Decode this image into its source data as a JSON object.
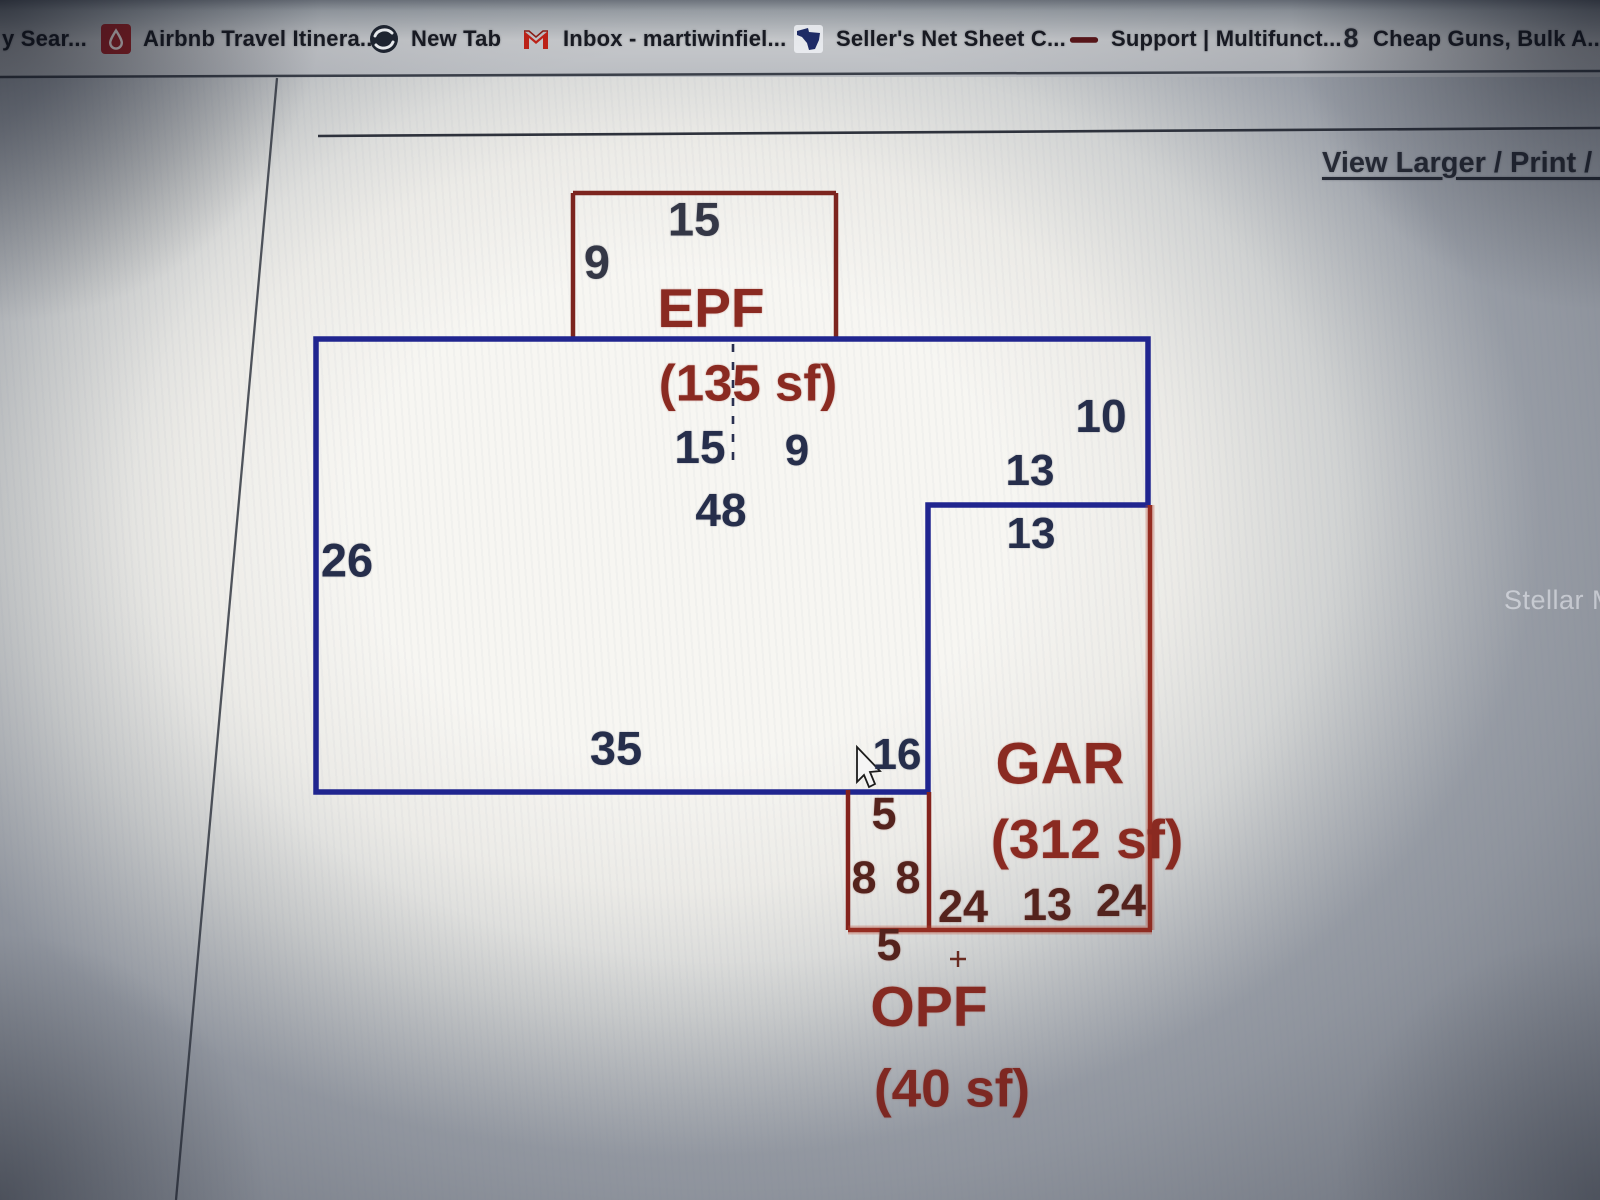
{
  "bookmarks": {
    "items": [
      {
        "label": "y Sear...",
        "icon": "none"
      },
      {
        "label": "Airbnb Travel Itinera...",
        "icon": "airbnb"
      },
      {
        "label": "New Tab",
        "icon": "globe"
      },
      {
        "label": "Inbox - martiwinfiel...",
        "icon": "gmail"
      },
      {
        "label": "Seller's Net Sheet C...",
        "icon": "florida"
      },
      {
        "label": "Support | Multifunct...",
        "icon": "dash"
      },
      {
        "label": "Cheap Guns, Bulk A...",
        "icon": "eight"
      }
    ]
  },
  "page": {
    "view_larger_link": "View Larger / Print / S",
    "watermark": "Stellar MLS"
  },
  "sketch": {
    "labels": {
      "epf_top": "15",
      "epf_left": "9",
      "epf_code": "EPF",
      "epf_area": "(135 sf)",
      "fla_seg_left": "15",
      "fla_seg_right": "9",
      "fla_top": "48",
      "fla_left": "26",
      "fla_bottom": "35",
      "fla_right_upper": "10",
      "fla_right_lower": "16",
      "gar_top_outer": "13",
      "gar_top_inner": "13",
      "gar_code": "GAR",
      "gar_area": "(312 sf)",
      "gar_bottom_left": "24",
      "gar_bottom_mid": "13",
      "gar_bottom_right": "24",
      "opf_top": "5",
      "opf_side_left": "8",
      "opf_side_right": "8",
      "opf_bottom": "5",
      "opf_code": "OPF",
      "opf_area": "(40 sf)"
    },
    "colors": {
      "living_line": "#20258f",
      "nonliving_line": "#84231d",
      "red_text": "#8a2a21",
      "navy_text": "#262e4b"
    }
  }
}
